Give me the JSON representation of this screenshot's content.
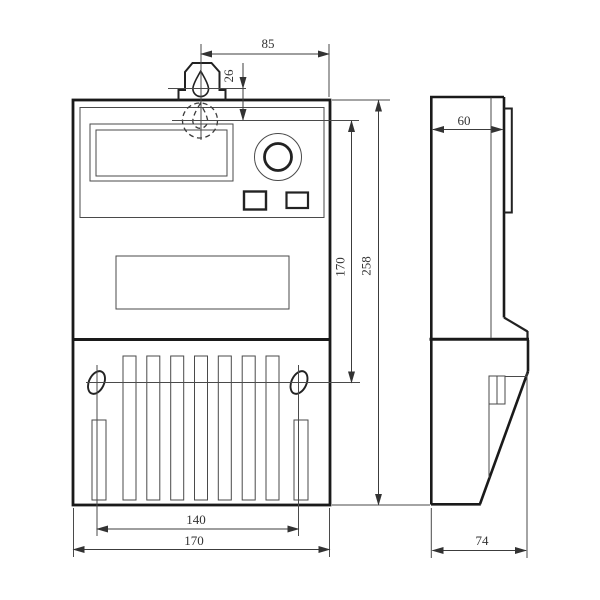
{
  "meta": {
    "background": "#ffffff",
    "thick_line_color": "#1a1a1a",
    "thin_line_color": "#4a4a4a",
    "text_color": "#333333"
  },
  "front_view": {
    "dim_top_width": "85",
    "dim_hook_offset": "26",
    "dim_window_height": "170",
    "dim_overall_height": "258",
    "dim_hole_spacing": "140",
    "dim_overall_width": "170"
  },
  "side_view": {
    "dim_depth_top": "60",
    "dim_depth_overall": "74"
  }
}
